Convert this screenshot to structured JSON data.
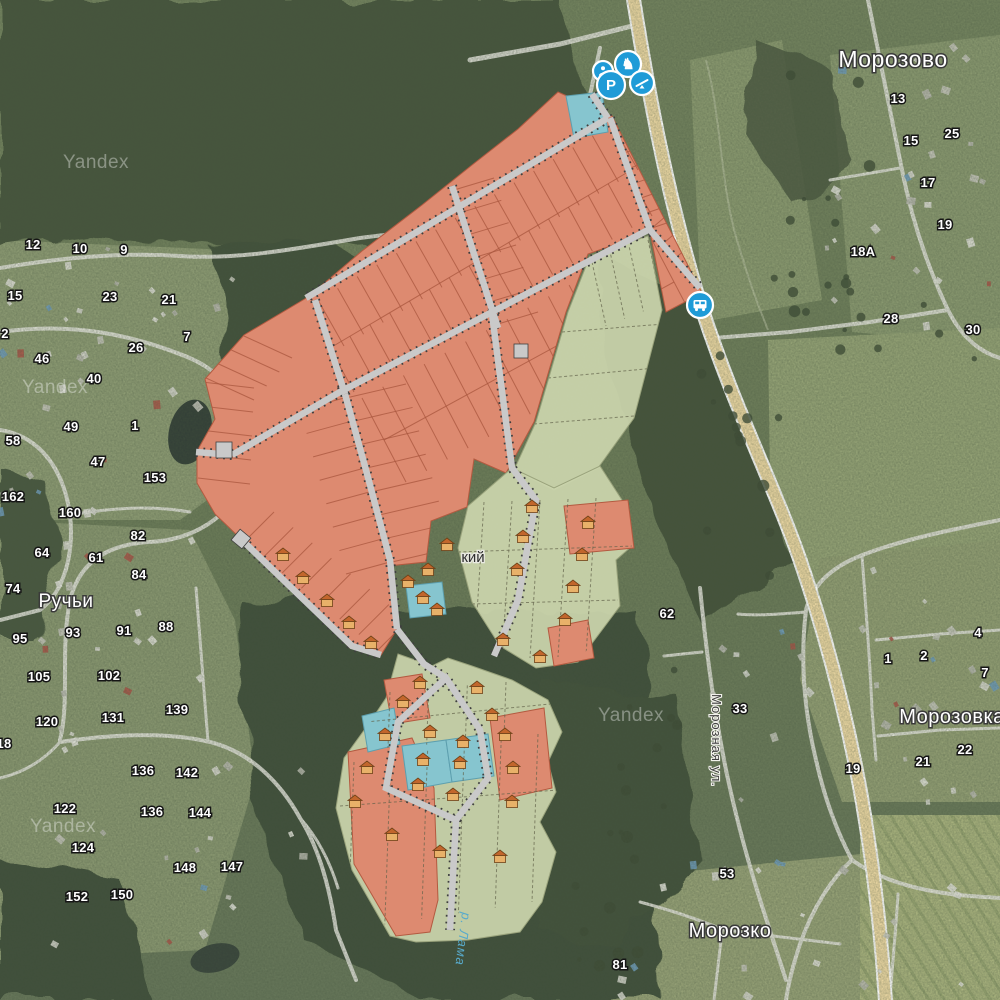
{
  "map": {
    "watermark_text": "Yandex",
    "watermarks": [
      {
        "x": 63,
        "y": 168
      },
      {
        "x": 22,
        "y": 393
      },
      {
        "x": 30,
        "y": 832
      },
      {
        "x": 598,
        "y": 721
      }
    ],
    "place_labels": [
      {
        "name": "morozovo",
        "text": "Морозово",
        "x": 893,
        "y": 67,
        "size": 23,
        "style": "light"
      },
      {
        "name": "ruchi",
        "text": "Ручьи",
        "x": 66,
        "y": 607,
        "size": 19,
        "style": "light"
      },
      {
        "name": "morozovka",
        "text": "Морозовка",
        "x": 952,
        "y": 723,
        "size": 20,
        "style": "light"
      },
      {
        "name": "morozko",
        "text": "Морозко",
        "x": 730,
        "y": 937,
        "size": 20,
        "style": "light"
      },
      {
        "name": "partial-settlement",
        "text": "кий",
        "x": 473,
        "y": 562,
        "size": 15,
        "style": "dark"
      }
    ],
    "street_label": {
      "text": "Морозная ул."
    },
    "water_label": {
      "text": "р. Лама"
    },
    "house_numbers": [
      {
        "x": 33,
        "y": 249,
        "t": "12"
      },
      {
        "x": 80,
        "y": 253,
        "t": "10"
      },
      {
        "x": 124,
        "y": 254,
        "t": "9"
      },
      {
        "x": 15,
        "y": 300,
        "t": "15"
      },
      {
        "x": 110,
        "y": 301,
        "t": "23"
      },
      {
        "x": 169,
        "y": 304,
        "t": "21"
      },
      {
        "x": 5,
        "y": 338,
        "t": "2"
      },
      {
        "x": 187,
        "y": 341,
        "t": "7"
      },
      {
        "x": 136,
        "y": 352,
        "t": "26"
      },
      {
        "x": 42,
        "y": 363,
        "t": "46"
      },
      {
        "x": 94,
        "y": 383,
        "t": "40"
      },
      {
        "x": 71,
        "y": 431,
        "t": "49"
      },
      {
        "x": 135,
        "y": 430,
        "t": "1"
      },
      {
        "x": 13,
        "y": 445,
        "t": "58"
      },
      {
        "x": 98,
        "y": 466,
        "t": "47"
      },
      {
        "x": 155,
        "y": 482,
        "t": "153"
      },
      {
        "x": 13,
        "y": 501,
        "t": "162"
      },
      {
        "x": 70,
        "y": 517,
        "t": "160"
      },
      {
        "x": 138,
        "y": 540,
        "t": "82"
      },
      {
        "x": 42,
        "y": 557,
        "t": "64"
      },
      {
        "x": 96,
        "y": 562,
        "t": "61"
      },
      {
        "x": 139,
        "y": 579,
        "t": "84"
      },
      {
        "x": 13,
        "y": 593,
        "t": "74"
      },
      {
        "x": 73,
        "y": 637,
        "t": "93"
      },
      {
        "x": 124,
        "y": 635,
        "t": "91"
      },
      {
        "x": 166,
        "y": 631,
        "t": "88"
      },
      {
        "x": 20,
        "y": 643,
        "t": "95"
      },
      {
        "x": 39,
        "y": 681,
        "t": "105"
      },
      {
        "x": 109,
        "y": 680,
        "t": "102"
      },
      {
        "x": 177,
        "y": 714,
        "t": "139"
      },
      {
        "x": 47,
        "y": 726,
        "t": "120"
      },
      {
        "x": 113,
        "y": 722,
        "t": "131"
      },
      {
        "x": 4,
        "y": 748,
        "t": "18"
      },
      {
        "x": 143,
        "y": 775,
        "t": "136"
      },
      {
        "x": 187,
        "y": 777,
        "t": "142"
      },
      {
        "x": 65,
        "y": 813,
        "t": "122"
      },
      {
        "x": 152,
        "y": 816,
        "t": "136"
      },
      {
        "x": 200,
        "y": 817,
        "t": "144"
      },
      {
        "x": 83,
        "y": 852,
        "t": "124"
      },
      {
        "x": 185,
        "y": 872,
        "t": "148"
      },
      {
        "x": 232,
        "y": 871,
        "t": "147"
      },
      {
        "x": 77,
        "y": 901,
        "t": "152"
      },
      {
        "x": 122,
        "y": 899,
        "t": "150"
      },
      {
        "x": 898,
        "y": 103,
        "t": "13"
      },
      {
        "x": 911,
        "y": 145,
        "t": "15"
      },
      {
        "x": 952,
        "y": 138,
        "t": "25"
      },
      {
        "x": 928,
        "y": 187,
        "t": "17"
      },
      {
        "x": 945,
        "y": 229,
        "t": "19"
      },
      {
        "x": 863,
        "y": 256,
        "t": "18А"
      },
      {
        "x": 891,
        "y": 323,
        "t": "28"
      },
      {
        "x": 973,
        "y": 334,
        "t": "30"
      },
      {
        "x": 667,
        "y": 618,
        "t": "62"
      },
      {
        "x": 740,
        "y": 713,
        "t": "33"
      },
      {
        "x": 888,
        "y": 663,
        "t": "1"
      },
      {
        "x": 924,
        "y": 660,
        "t": "2"
      },
      {
        "x": 978,
        "y": 637,
        "t": "4"
      },
      {
        "x": 985,
        "y": 677,
        "t": "7"
      },
      {
        "x": 965,
        "y": 754,
        "t": "22"
      },
      {
        "x": 923,
        "y": 766,
        "t": "21"
      },
      {
        "x": 853,
        "y": 773,
        "t": "19"
      },
      {
        "x": 727,
        "y": 878,
        "t": "53"
      },
      {
        "x": 620,
        "y": 969,
        "t": "81"
      }
    ],
    "markers": {
      "cluster": [
        {
          "x": 603,
          "y": 71,
          "r": 10,
          "icon": "guard-icon"
        },
        {
          "x": 628,
          "y": 64,
          "r": 13,
          "icon": "playground-icon"
        },
        {
          "x": 642,
          "y": 83,
          "r": 12,
          "icon": "seesaw-icon"
        },
        {
          "x": 611,
          "y": 85,
          "r": 14,
          "icon": "parking-icon",
          "label": "P"
        }
      ],
      "bus_stop": {
        "x": 700,
        "y": 305,
        "r": 13,
        "icon": "bus-icon"
      }
    },
    "plan": {
      "houses": [
        [
          283,
          555
        ],
        [
          303,
          578
        ],
        [
          327,
          601
        ],
        [
          349,
          623
        ],
        [
          371,
          643
        ],
        [
          532,
          507
        ],
        [
          588,
          523
        ],
        [
          523,
          537
        ],
        [
          447,
          545
        ],
        [
          582,
          555
        ],
        [
          428,
          570
        ],
        [
          517,
          570
        ],
        [
          408,
          582
        ],
        [
          573,
          587
        ],
        [
          423,
          598
        ],
        [
          437,
          610
        ],
        [
          565,
          620
        ],
        [
          503,
          640
        ],
        [
          540,
          657
        ],
        [
          420,
          683
        ],
        [
          477,
          688
        ],
        [
          403,
          702
        ],
        [
          492,
          715
        ],
        [
          385,
          735
        ],
        [
          430,
          732
        ],
        [
          505,
          735
        ],
        [
          463,
          742
        ],
        [
          367,
          768
        ],
        [
          423,
          760
        ],
        [
          460,
          763
        ],
        [
          513,
          768
        ],
        [
          418,
          785
        ],
        [
          453,
          795
        ],
        [
          355,
          802
        ],
        [
          512,
          802
        ],
        [
          392,
          835
        ],
        [
          440,
          852
        ],
        [
          500,
          857
        ]
      ]
    }
  },
  "colors": {
    "plot_orange": "#dd8a70",
    "plot_green": "#ccd6ae",
    "plot_blue": "#86c5cf",
    "overlay_road": "#c9c9c9",
    "highway": "#eed9a4",
    "marker_blue": "#1f9bd7",
    "water_label": "#58aacb"
  }
}
